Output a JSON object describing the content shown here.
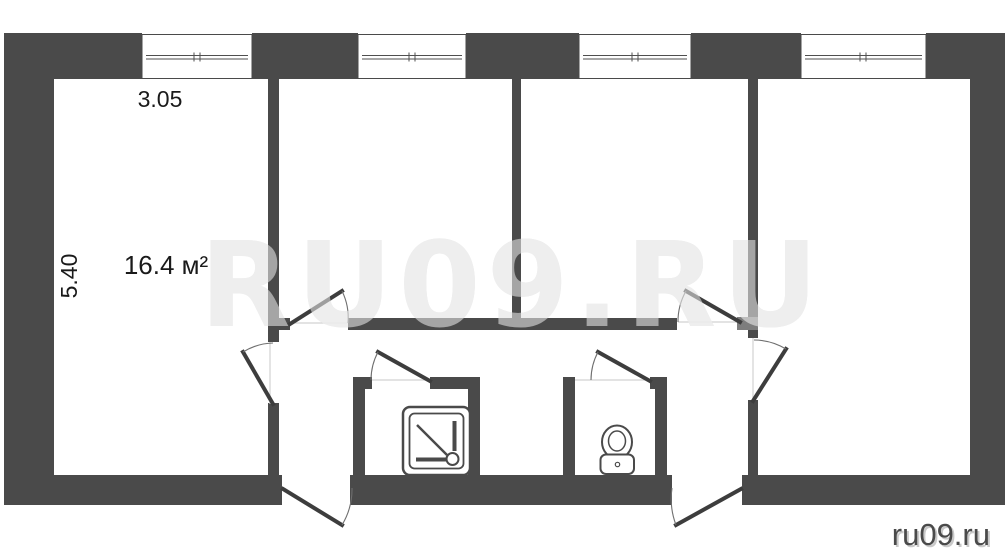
{
  "watermark": {
    "text": "RU09.RU"
  },
  "site": {
    "label": "ru09.ru"
  },
  "room": {
    "width_m": "3.05",
    "depth_m": "5.40",
    "area": "16.4 м²"
  },
  "fixtures": {
    "shower": "shower-tray-icon",
    "toilet": "toilet-icon"
  },
  "colors": {
    "wall": "#4a4a4a",
    "wall-light": "#7d7d7d",
    "label": "#1a1a1a",
    "watermark": "#dcdcdc",
    "site": "#4a4a4a",
    "background": "#ffffff"
  }
}
